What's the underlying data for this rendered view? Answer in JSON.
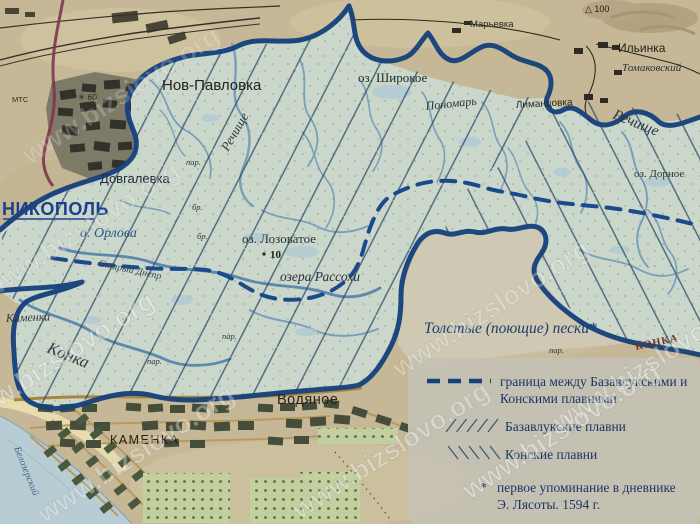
{
  "map": {
    "labels": {
      "nikopol": "НИКОПОЛЬ",
      "orlova": "о. Орлова",
      "dovgalevka": "Довгалевка",
      "nov_pavlovka": "Нов-Павловка",
      "rechishche": "Речище",
      "oz_shirokoe": "оз. Широкое",
      "ponomar": "Пономарь",
      "marevka": "Марьевка",
      "ilinka": "Ильинка",
      "tomakovsky": "Томаковский",
      "height_100": "△ 100",
      "limantsovka": "Лиманцовка",
      "oz_dornoe": "оз. Дорное",
      "stary_dnepr": "Старый Днепр",
      "oz_lozovatoe": "оз. Лозоватое",
      "depth_10": "10",
      "ozera_rassokhi": "озера Рассохи",
      "tolstye_peski": "Толстые (поющие) пески*",
      "kamenka_river": "Каменка",
      "konka_river": "Конка",
      "konka_red": "КОНКА",
      "vodyanoe": "Водяное",
      "kamenka_town": "КАМЕНКА",
      "mts": "МТС",
      "spot_60": "✳ 60",
      "belozersky": "Белозерский",
      "par": "пар.",
      "br": "бр."
    }
  },
  "legend": {
    "boundary_label_line1": "граница между Базавлукскими и",
    "boundary_label_line2": "Конскими плавнями",
    "bazavluk_label": "Базавлукские плавни",
    "konski_label": "Конские плавни",
    "footnote_marker": "*",
    "footnote_line1": "первое упоминание в дневнике",
    "footnote_line2": "Э. Лясоты. 1594 г."
  },
  "watermark": {
    "text": "www.bizslovo.org"
  },
  "colors": {
    "boundary_blue": "#16427c",
    "hatch_line": "#2c4a66",
    "legend_text": "#1b3566",
    "paper": "#c6b896",
    "marsh": "#cbd7cb",
    "red_road": "#82344e"
  }
}
